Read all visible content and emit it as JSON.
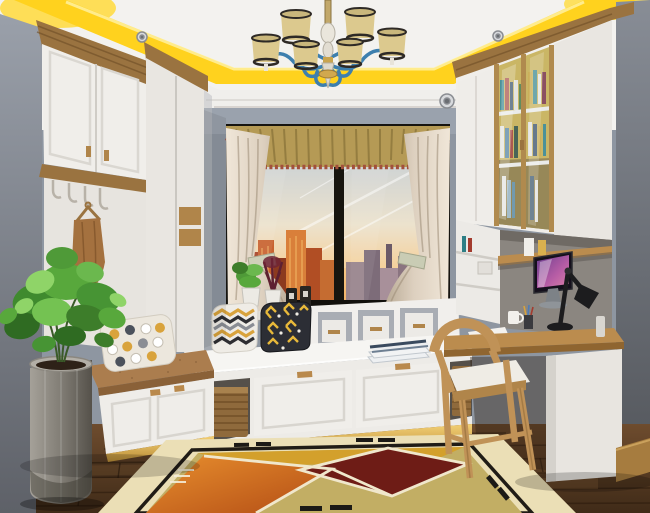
{
  "scene": {
    "type": "interior-photo",
    "description": "Small study bedroom rendered in one-point perspective: tray ceiling with yellow cove lighting and blue-armed chandelier, bay window with sunset city view, cream curtains and gold valance, white window-seat platform with drawers and wicker baskets, left coat nook and bench, right glass-door bookcase with built-in desk, wooden chair, potted plant, geometric rug on dark wood floor",
    "objects": [
      "tray-ceiling",
      "cove-lighting",
      "recessed-spotlights",
      "chandelier",
      "window",
      "city-view",
      "valance",
      "curtains",
      "upper-cabinet",
      "coat-hooks",
      "coat",
      "wardrobe",
      "bench",
      "bench-pillow",
      "planter",
      "plant",
      "window-seat-platform",
      "cubby-shelf",
      "chevron-pillow",
      "geometric-pillow",
      "books",
      "drawers",
      "wicker-baskets",
      "bookcase",
      "glass-doors",
      "desk",
      "computer",
      "desk-lamp",
      "chair",
      "wood-floor",
      "area-rug"
    ]
  },
  "palette": {
    "ceiling": "#f3f2ef",
    "cove_yellow": "#ffd21e",
    "wall_gray": "#8e96a1",
    "left_wall": "#868c95",
    "right_wall": "#72767e",
    "wood_trim": "#9a7340",
    "cabinet_white": "#f0eeea",
    "panel_white": "#e9e6e1",
    "window_frame": "#161410",
    "valance_gold": "#b59a55",
    "fringe_red": "#a2503c",
    "curtain_cream": "#ece2d2",
    "sky_top": "#c6cfd6",
    "sunset_orange": "#e8903c",
    "platform_white": "#f6f5f2",
    "cushion_tan": "#ab7d4e",
    "pillow_yellow": "#d9a33c",
    "pillow_dark": "#2c2e35",
    "basket_wicker": "#8f6a3c",
    "floor_wood": "#5d3f26",
    "toe_kick_lit": "#e3b45a",
    "rug_cream": "#ebdfb6",
    "rug_orange": "#cf6a1e",
    "rug_maroon": "#6e1c16",
    "rug_olive": "#c2ae64",
    "rug_gold": "#d3a02c",
    "chair_oak": "#c09257",
    "desk_wood": "#bb8c4e",
    "alcove_gray": "#8b8680",
    "lamp_black": "#1c1c1e",
    "screen_purple": "#8a4fb0",
    "chandelier_blue": "#3d7fae",
    "shade_cream": "#dcc98e",
    "plant_green": "#58a83c",
    "planter_gray": "#8f8b83"
  }
}
